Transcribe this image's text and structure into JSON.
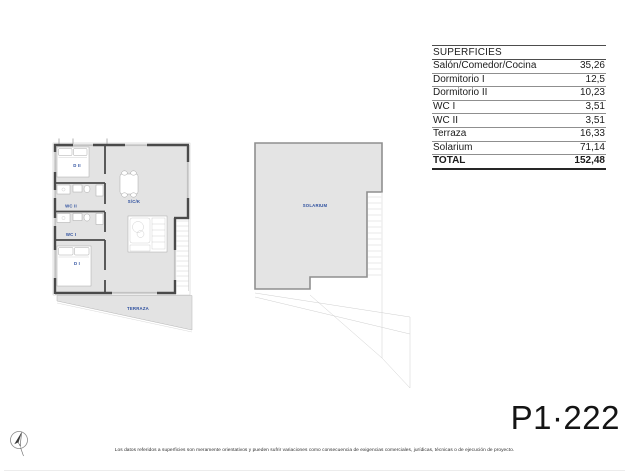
{
  "table": {
    "header": "SUPERFICIES",
    "rows": [
      {
        "label": "Salón/Comedor/Cocina",
        "value": "35,26"
      },
      {
        "label": "Dormitorio I",
        "value": "12,5"
      },
      {
        "label": "Dormitorio II",
        "value": "10,23"
      },
      {
        "label": "WC I",
        "value": "3,51"
      },
      {
        "label": "WC II",
        "value": "3,51"
      },
      {
        "label": "Terraza",
        "value": "16,33"
      },
      {
        "label": "Solarium",
        "value": "71,14"
      }
    ],
    "total_label": "TOTAL",
    "total_value": "152,48"
  },
  "floor_plan": {
    "labels": {
      "dormitorio2": "D II",
      "wc2": "WC II",
      "wc1": "WC I",
      "dormitorio1": "D I",
      "salon": "S/C/K",
      "terraza": "TERRAZA"
    }
  },
  "roof_plan": {
    "labels": {
      "solarium": "SOLARIUM"
    }
  },
  "plan_code": "P1·222",
  "footer_disclaimer": "Los datos referidos a superficies son meramente orientativos y pueden sufrir variaciones como consecuencia de exigencias comerciales, jurídicas, técnicas o de ejecución de proyecto.",
  "colors": {
    "room_label_blue": "#2d4f9e",
    "floor_fill": "#e3e3e3",
    "wall_dark": "#4a4a4a",
    "text_dark": "#1c1c1c"
  }
}
